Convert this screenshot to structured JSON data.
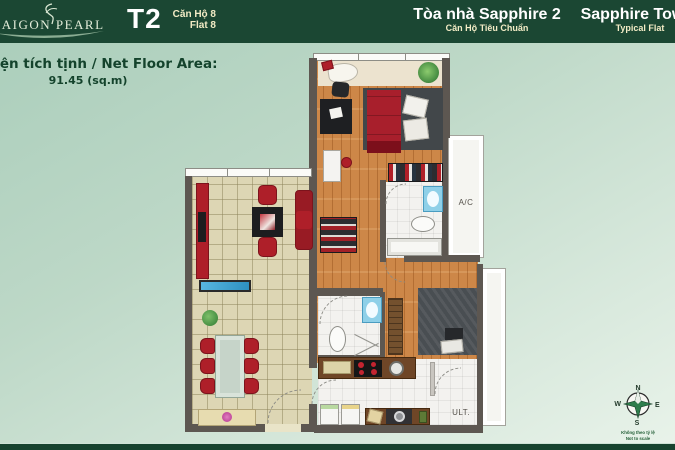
{
  "header": {
    "logo_brand": "SAIGON PEARL",
    "unit_code": "T2",
    "unit_label_vi": "Căn Hộ 8",
    "unit_label_en": "Flat 8",
    "building_title_vi": "Tòa nhà Sapphire 2",
    "building_subtitle_vi": "Căn Hộ Tiêu Chuẩn",
    "building_title_en": "Sapphire Tower",
    "building_subtitle_en": "Typical Flat"
  },
  "area": {
    "label": "Diện tích tịnh / Net Floor Area:",
    "value": "91.45 (sq.m)"
  },
  "plan": {
    "ac_label": "A/C",
    "utility_label": "ULT."
  },
  "compass": {
    "n": "N",
    "e": "E",
    "s": "S",
    "w": "W",
    "caption_line1": "Không theo tỷ lệ",
    "caption_line2": "Not to scale"
  },
  "colors": {
    "header_green": "#1b4733",
    "cream_text": "#f3ecc6",
    "accent_red": "#ae1f29",
    "wood_floor": "#cd8748",
    "tile_floor": "#ddd6b4",
    "wall_gray": "#5d5751",
    "background_green": "#b7d4c4"
  }
}
